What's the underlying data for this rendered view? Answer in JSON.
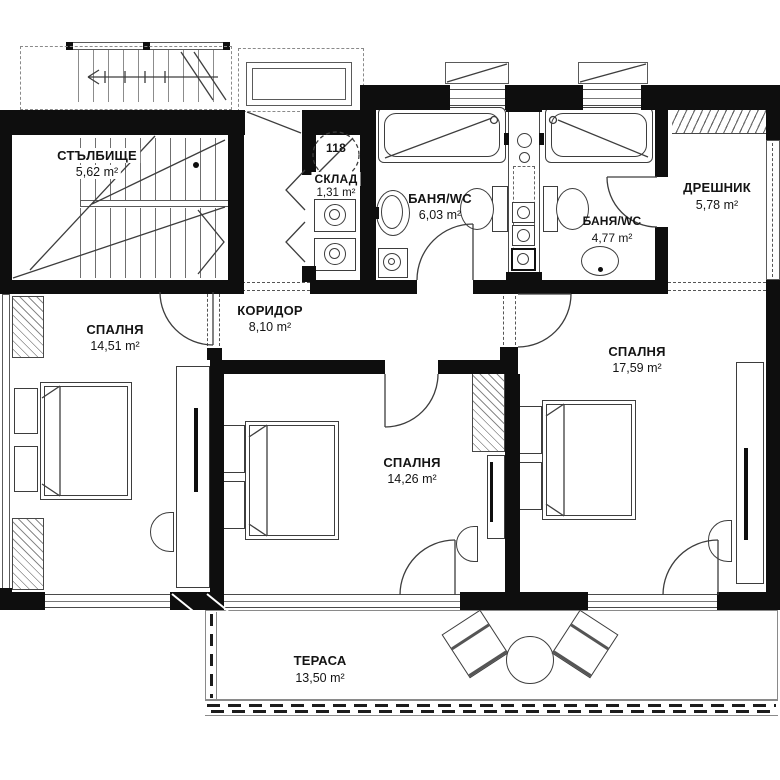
{
  "plan": {
    "unit_number": "118",
    "rooms": {
      "stairwell": {
        "name": "СТЪЛБИЩЕ",
        "area": "5,62 m²"
      },
      "storage": {
        "name": "СКЛАД",
        "area": "1,31 m²"
      },
      "bath1": {
        "name": "БАНЯ/WC",
        "area": "6,03 m²"
      },
      "bath2": {
        "name": "БАНЯ/WC",
        "area": "4,77 m²"
      },
      "closet": {
        "name": "ДРЕШНИК",
        "area": "5,78 m²"
      },
      "corridor": {
        "name": "КОРИДОР",
        "area": "8,10 m²"
      },
      "bedroom1": {
        "name": "СПАЛНЯ",
        "area": "14,51 m²"
      },
      "bedroom2": {
        "name": "СПАЛНЯ",
        "area": "14,26 m²"
      },
      "bedroom3": {
        "name": "СПАЛНЯ",
        "area": "17,59 m²"
      },
      "terrace": {
        "name": "ТЕРАСА",
        "area": "13,50 m²"
      }
    }
  },
  "colors": {
    "wall": "#0e0e0e",
    "line": "#3d3d3d",
    "text": "#141414",
    "background": "#ffffff"
  }
}
